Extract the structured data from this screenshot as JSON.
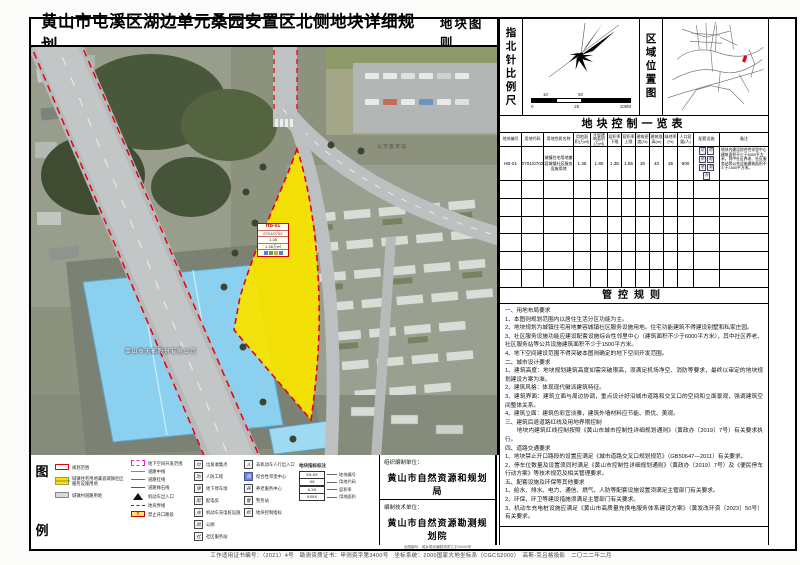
{
  "title": {
    "main": "黄山市屯溪区湖边单元桑园安置区北侧地块详细规划",
    "sub": "地块图则"
  },
  "compass": {
    "label": "指北针比例尺",
    "scale_upper": [
      "10",
      "50"
    ],
    "scale_lower": [
      "0",
      "25",
      "100M"
    ]
  },
  "region": {
    "label": "区域位置图"
  },
  "control_table": {
    "title": "地块控制一览表",
    "headers": [
      "地块编号",
      "用地代码",
      "用地性质名称",
      "用地面积(万㎡)",
      "计容建筑面积(万㎡)",
      "容积率下限",
      "容积率上限",
      "建筑密度(%)",
      "建筑限高(m)",
      "绿地率(%)",
      "人口容量(人)",
      "配套设施",
      "备注"
    ],
    "row_cells": [
      "HB-01",
      "0701/0702",
      "城镇住宅用地兼容城镇社区服务设施用地",
      "1.38",
      "1.90",
      "1.38",
      "1.55",
      "30",
      "40",
      "35",
      "800"
    ],
    "facilities": [
      "垃",
      "防",
      "停",
      "配",
      "充",
      "厕",
      "社"
    ],
    "remark": "地块内建设综合性邻里中心建筑面积不少于6000平方米，其中社区养老、社区服务站等公共设施建筑面积不少于1500平方米。",
    "empty_rows": 6
  },
  "rules": {
    "title": "管控规则",
    "lines": [
      "一、用地布局要求",
      "1、本图则规划范围内以居住生活分区功能为主。",
      "2、地块规划为城镇住宅用地兼容城镇社区服务设施用地。住宅功能建筑不得建设别墅和私家庄园。",
      "3、社区服务设施功能应建设配套设施综合性邻里中心（建筑面积不少于6000平方米），其中社区养老、社区服务站等公共设施建筑面积不少于1500平方米。",
      "4、地下空间建设范围不得突破本图则确定的地下空间开发范围。",
      "二、城市设计要求",
      "1、建筑高度：地块规划建筑高度如需突破限高，须满足机场净空、消防等要求，最终以审定的地块规划建设方案为准。",
      "2、建筑风格：体现现代徽派建筑特征。",
      "3、建筑界面：建筑立面与周边协调，重点设计好沿城市道路和交叉口的空间和立面景观，强调建筑空间整体关系。",
      "4、建筑立面：建筑色彩宜淡雅，建筑外墙材料应节能、质优、美观。",
      "三、建筑后退道路红线及用地界限控制",
      "　　地块内建筑红线控制按照《黄山市城市控制性详细规划通则》（黄政办〔2019〕7号）有关要求执行。",
      "四、道路交通要求",
      "1、地块禁止开口路段的设置应满足《城市道路交叉口规划规范》（GB50647—2011）有关要求。",
      "2、停车位数量及设置须同时满足《黄山市控制性详细规划通则》（黄政办〔2019〕7号）及《便民停车行动方案》等技术规范及相关管理要求。",
      "五、配套设施及环保等其他要求",
      "1、给水、排水、电力、通信、燃气、人防等配套设施设置须满足主管部门有关要求。",
      "2、环保、环卫等建设措施须满足主管部门有关要求。",
      "3、机动车充电桩设施应满足《黄山市高质量充换电服务体系建设方案》（黄发改环资〔2023〕50号）有关要求。"
    ]
  },
  "legend": {
    "label_chars": [
      "图",
      "例"
    ],
    "col1": [
      {
        "type": "red-outline",
        "label": "规划范围"
      },
      {
        "type": "yellow-fill",
        "code": "0701/0702",
        "label": "城镇住宅用地兼容城镇社区服务设施用地"
      },
      {
        "type": "gray-fill",
        "label": "城镇村道路用地"
      }
    ],
    "col2": [
      {
        "type": "magenta-dash",
        "label": "地下空间开发范围"
      },
      {
        "type": "line-center",
        "label": "道路中线"
      },
      {
        "type": "line-red",
        "label": "道路红线"
      },
      {
        "type": "line-curb",
        "label": "道路缘石线"
      },
      {
        "type": "arrow",
        "label": "机动车出入口"
      },
      {
        "type": "line-plot",
        "label": "地块界线"
      },
      {
        "type": "no-open",
        "label": "禁止开口路段"
      }
    ],
    "col3": [
      {
        "icon": "垃",
        "label": "垃圾收集点"
      },
      {
        "icon": "防",
        "label": "人防工程"
      },
      {
        "icon": "停",
        "label": "地下停车场"
      },
      {
        "icon": "配",
        "label": "配电房"
      },
      {
        "icon": "充",
        "label": "机动车充电桩设施"
      },
      {
        "icon": "厕",
        "label": "公厕"
      },
      {
        "icon": "社",
        "label": "社区服务站"
      }
    ],
    "col4": [
      {
        "icon": "人",
        "label": "非机动车人行出入口"
      },
      {
        "icon": "邻",
        "label": "综合性邻里中心",
        "accent": true
      },
      {
        "icon": "养",
        "label": "养老服务中心"
      },
      {
        "icon": "警",
        "label": "警务站"
      },
      {
        "icon": "标",
        "label": "地块控制指标"
      }
    ],
    "annotation": {
      "title": "地块指标标注",
      "rows": [
        {
          "sample": "XX-XX",
          "label": "地块编号"
        },
        {
          "sample": "XX",
          "label": "用地代码"
        },
        {
          "sample": "X.XX",
          "label": "容积率"
        },
        {
          "sample": "XXXX",
          "label": "用地面积"
        }
      ]
    }
  },
  "credits": {
    "org_label": "组织编制单位：",
    "org_name": "黄山市自然资源和规划局",
    "tech_label": "编制技术单位：",
    "tech_name": "黄山市自然资源勘测规划院",
    "cert": "出图编号：城乡规划编制资质乙字34040号"
  },
  "map": {
    "plot_tag": [
      "HB-01",
      "0701/0702",
      "1.38",
      "1.38万㎡"
    ],
    "factory_label": "黄山市天都股份有限公司",
    "bus_label": "公交首末站"
  },
  "footer": "工作适用证书编号：（2021）4号　勘测资质证书：甲测资字第3400号　坐标系统：2000国家大地坐标系（CGCS2000）　高斯-克吕格投影　二〇二二年二月",
  "colors": {
    "plot_yellow": "#f8e400",
    "boundary_red": "#e60012",
    "underground_magenta": "#ee22cc",
    "roof_blue": "#8bd0ef",
    "accent_blue": "#6f86d8"
  }
}
